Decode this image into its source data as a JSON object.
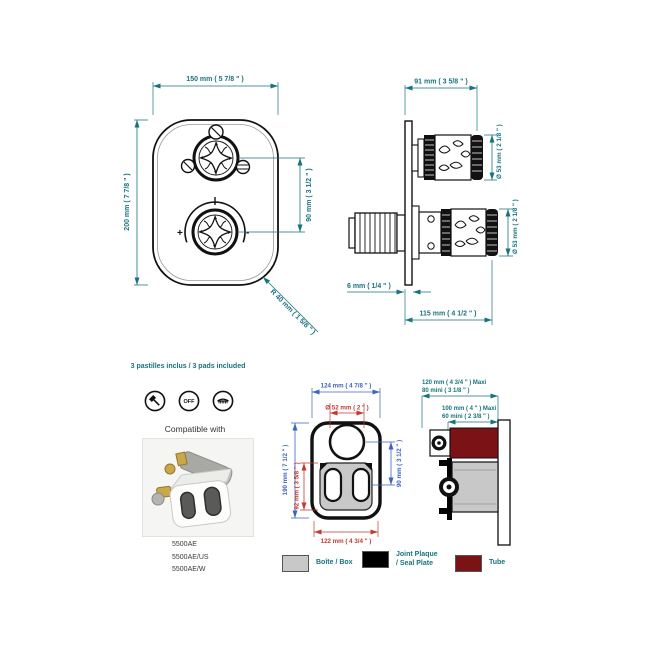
{
  "colors": {
    "dimension_teal": "#17737e",
    "dimension_blue": "#3c64c0",
    "dimension_red": "#c43a30",
    "tube": "#7a1216",
    "box_gray": "#c8c8c8",
    "seal_black": "#000000"
  },
  "front_view": {
    "width_dim": "150 mm ( 5 7/8 \" )",
    "height_dim": "200 mm ( 7 7/8 \" )",
    "knob_spacing_dim": "90 mm ( 3 1/2 \" )",
    "corner_radius_dim": "R 40 mm ( 1 5/8 \" )",
    "plus": "+",
    "minus": "-"
  },
  "side_view": {
    "projection_dim": "91 mm ( 3 5/8 \" )",
    "top_knob_dia_dim": "Ø 53 mm ( 2 1/8 \" )",
    "bottom_knob_dia_dim": "Ø 53 mm ( 2 1/8 \" )",
    "plate_thickness_dim": "6 mm ( 1/4 \" )",
    "total_depth_dim": "115 mm ( 4 1/2 \" )"
  },
  "pads": {
    "title": "3 pastilles inclus / 3 pads included",
    "icons": [
      {
        "name": "hand-shower-icon"
      },
      {
        "name": "off-icon",
        "label": "OFF"
      },
      {
        "name": "overhead-shower-icon"
      }
    ],
    "compatible_label": "Compatible with",
    "models": [
      "5500AE",
      "5500AE/US",
      "5500AE/W"
    ]
  },
  "box_front_view": {
    "width_dim": "124 mm ( 4 7/8 \" )",
    "hole_dia_dim": "Ø 52 mm ( 2 \" )",
    "height_dim": "190 mm ( 7 1/2 \" )",
    "plate_height_dim": "92 mm ( 3 5/8 \" )",
    "center_spacing_dim": "90 mm ( 3 1/2 \" )",
    "bottom_width_dim": "122 mm ( 4 3/4 \" )"
  },
  "box_side_view": {
    "depth1_max": "120 mm ( 4 3/4 \" )  Maxi",
    "depth1_min": "80 mini  ( 3 1/8 \" )",
    "depth2_max": "100 mm ( 4 \" )  Maxi",
    "depth2_min": "60 mini  ( 2 3/8 \" )"
  },
  "legend": {
    "items": [
      {
        "label_lines": [
          "Boîte / Box"
        ],
        "color": "#c8c8c8"
      },
      {
        "label_lines": [
          "Joint Plaque",
          "/ Seal Plate"
        ],
        "color": "#000000"
      },
      {
        "label_lines": [
          "Tube"
        ],
        "color": "#7a1216"
      }
    ]
  }
}
